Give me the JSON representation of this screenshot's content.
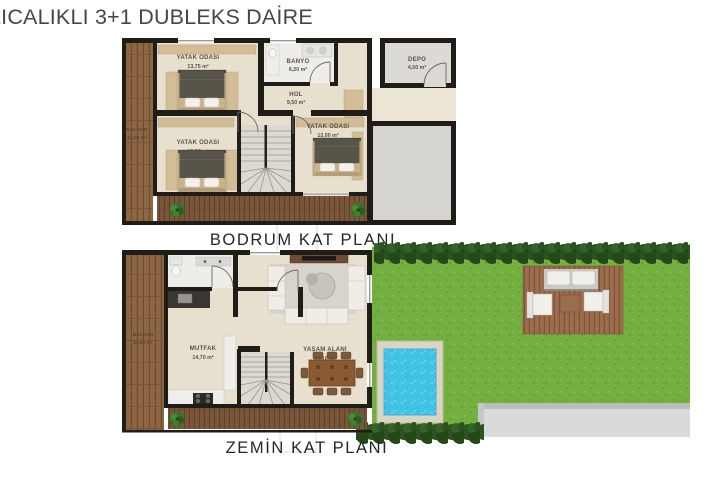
{
  "title": "LICALIKLI 3+1 DUBLEKS DAİRE",
  "floors": {
    "basement": {
      "caption": "BODRUM KAT PLANI",
      "balkon_name": "BALKON",
      "balkon_area": "13,05 m²",
      "yatak1_name": "YATAK ODASI",
      "yatak1_area": "13,75 m²",
      "banyo_name": "BANYO",
      "banyo_area": "6,20 m²",
      "hol_name": "HOL",
      "hol_area": "9,50 m²",
      "yatak2_name": "YATAK ODASI",
      "yatak2_area": "10,90 m²",
      "yatak3_name": "YATAK ODASI",
      "yatak3_area": "12,00 m²",
      "depo_name": "DEPO",
      "depo_area": "4,50 m²"
    },
    "ground": {
      "caption": "ZEMİN KAT PLANI",
      "balkon_name": "BALKON",
      "balkon_area": "13,05 m²",
      "mutfak_name": "MUTFAK",
      "mutfak_area": "14,70 m²",
      "yasam_name": "YAŞAM ALANI",
      "yasam_area": "34,10 m²"
    }
  },
  "colors": {
    "wall": "#201d19",
    "floor_cream": "#e8e0cf",
    "wood_deck": "#7a573a",
    "wood_balcony": "#8d6744",
    "grass": "#74b03f",
    "hedge": "#2c5420",
    "pool_water": "#41c3e6",
    "pool_edge": "#dbd3c3",
    "path_gray": "#dadada",
    "annex_gray": "#d5d4d0",
    "label_text": "#57524a",
    "title_text": "#42474c"
  }
}
